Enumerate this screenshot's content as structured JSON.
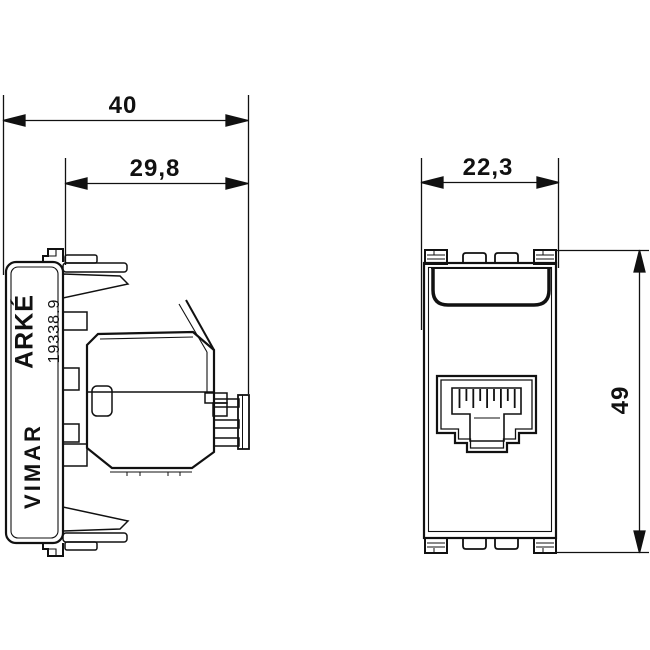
{
  "page": {
    "background": "#ffffff",
    "line_color": "#111111"
  },
  "dimensions": {
    "total_depth": "40",
    "mounting_depth": "29,8",
    "module_width": "22,3",
    "module_height": "49"
  },
  "markings": {
    "series": "ARKÉ",
    "part_number": "19338.9",
    "brand": "VIMAR"
  }
}
